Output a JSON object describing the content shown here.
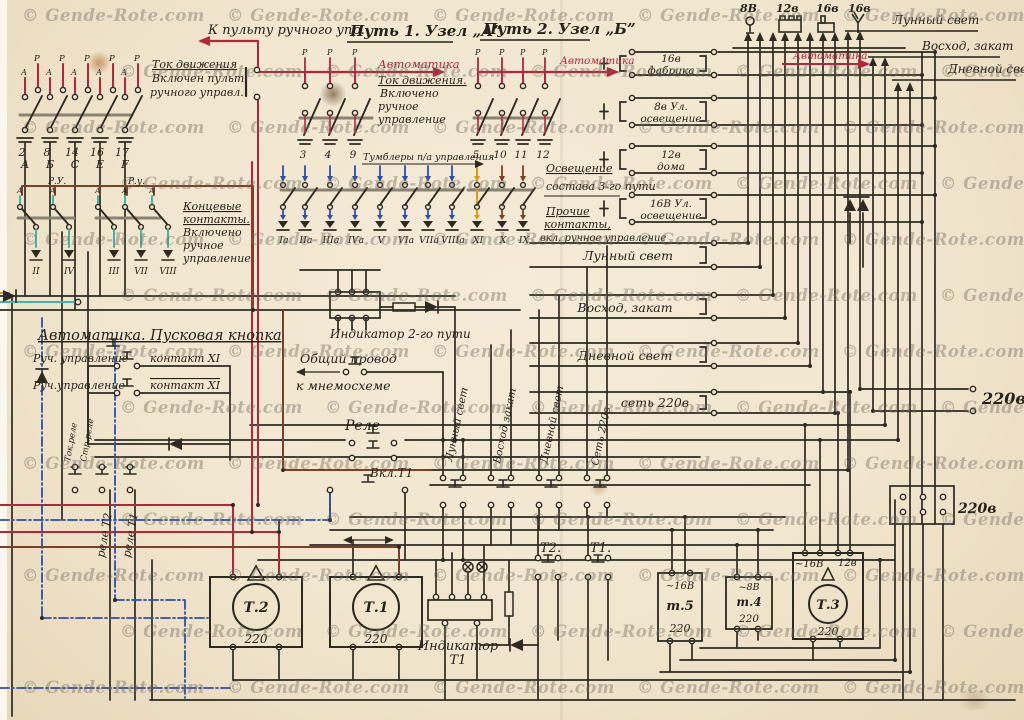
{
  "watermark": {
    "text": "© Gende-Rote.com"
  },
  "colors": {
    "ink": "#2e2a22",
    "red": "#b7243c",
    "blue": "#2b4fae",
    "teal": "#3fb8ab",
    "brown": "#7b4028",
    "orange": "#e09a10",
    "paper": "#f2e8d4"
  },
  "top_left": {
    "to_panel": "К пульту ручного упр.",
    "p": "Р",
    "a": "А",
    "note": [
      "Ток движения",
      "Включен пульт",
      "ручного управл."
    ],
    "numbers": [
      "2",
      "8",
      "14",
      "16",
      "17"
    ],
    "letters": [
      "А",
      "Б",
      "С",
      "Е",
      "F"
    ],
    "ru1": "Р.У.",
    "ru2": "Р.у.",
    "end_note": [
      "Концевые",
      "контакты.",
      "Включено",
      "ручное",
      "управление"
    ],
    "romans1": [
      "II",
      "IV"
    ],
    "romans2": [
      "III",
      "VII",
      "VIII"
    ]
  },
  "center_top": {
    "path1": "Путь 1. Узел „А”",
    "path2": "Путь 2. Узел „Б”",
    "automation1": "Автоматика",
    "automation2": "Автоматика",
    "automation3": "Автоматика",
    "note": [
      "Ток движения.",
      "Включено",
      "ручное",
      "управление"
    ],
    "numbers_a": [
      "3",
      "4",
      "9"
    ],
    "numbers_b": [
      "5",
      "10",
      "11",
      "12"
    ],
    "toggles_label": "Тумблеры п/а управления",
    "toggle_romans": [
      "Iа",
      "IIа",
      "IIIа",
      "IVа",
      "V",
      "VIа",
      "VIIа",
      "VIIIа",
      "XI",
      "X",
      "IX"
    ]
  },
  "lamps": [
    "8В",
    "12в",
    "16в",
    "16в"
  ],
  "sky": {
    "moon": "Лунный свет",
    "dawn": "Восход, закат",
    "day": "Дневной свет"
  },
  "relay_blocks": [
    [
      "16в",
      "фабрика"
    ],
    [
      "8в Ул.",
      "освещение"
    ],
    [
      "12в",
      "дома"
    ],
    [
      "16В Ул.",
      "освещение"
    ]
  ],
  "notes": {
    "lighting": [
      "Освещение",
      "состава 3-го пути"
    ],
    "other": [
      "Прочие",
      "контакты,",
      "вкл. ручное управление"
    ]
  },
  "scene_blocks": [
    "Лунный свет",
    "Восход, закат",
    "Дневной свет",
    "сеть 220в"
  ],
  "mains": {
    "v1": "220в",
    "v2": "220в"
  },
  "middle": {
    "indicator2": "Индикатор 2-го пути",
    "common": [
      "Общий провод",
      "к мнемосхеме"
    ],
    "relay": "Реле",
    "vkl": "Вкл.Т1",
    "vlabels": [
      "Лунный свет",
      "Восход закат",
      "Дневной свет",
      "Сеть 220в"
    ],
    "t2": "Т2.",
    "t1": "Т1."
  },
  "automation_box": {
    "title": "Автоматика. Пусковая кнопка",
    "manual1": "Руч. управление",
    "contact1": "контакт XI",
    "manual2": "Руч.управление",
    "contact2": "контакт XI",
    "tok": "Ток.реле",
    "str": "Стр.реле",
    "rt2": "реле Т2",
    "rt1": "реле Т1"
  },
  "transformers": {
    "t2": {
      "name": "Т.2",
      "v": "220"
    },
    "t1": {
      "name": "Т.1",
      "v": "220"
    },
    "ind": [
      "Индикатор",
      "Т1"
    ],
    "t5": {
      "vin": "~16В",
      "name": "т.5",
      "v": "220"
    },
    "t4": {
      "vin": "~8В",
      "name": "т.4",
      "v": "220"
    },
    "t3": {
      "vin1": "~16В",
      "vin2": "12в",
      "name": "Т.3",
      "v": "220"
    }
  }
}
